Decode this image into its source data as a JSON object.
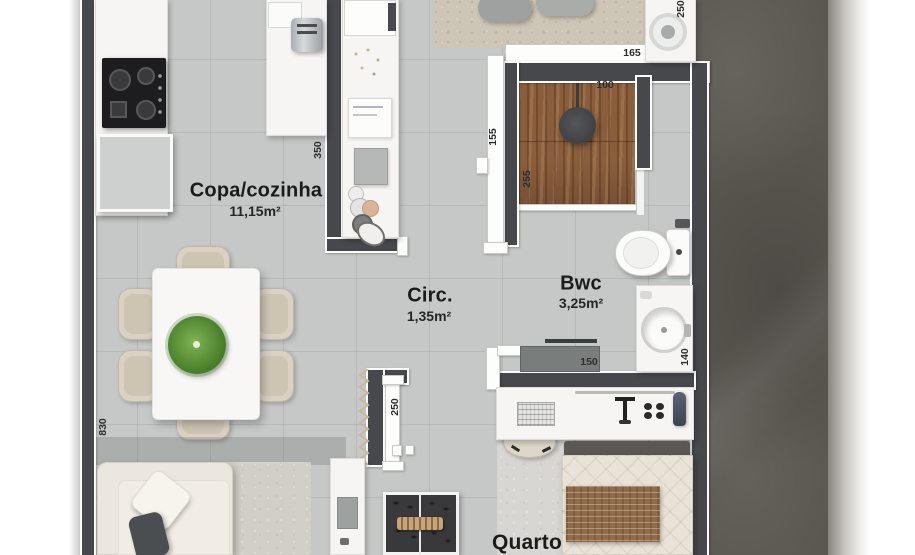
{
  "plan_title": "Apartment floor plan",
  "rooms": {
    "kitchen": {
      "name": "Copa/cozinha",
      "area": "11,15m²"
    },
    "circulation": {
      "name": "Circ.",
      "area": "1,35m²"
    },
    "bathroom": {
      "name": "Bwc",
      "area": "3,25m²"
    },
    "bedroom": {
      "name": "Quarto"
    }
  },
  "dimensions_cm": {
    "laundry_width": "250",
    "entry_width": "165",
    "shower_width": "100",
    "hall_door_width": "155",
    "shower_depth": "255",
    "kitchen_counter_length": "350",
    "living_length": "830",
    "bedroom_door_wall": "250",
    "vanity_width": "150",
    "vanity_depth": "140"
  },
  "colors": {
    "wall": "#47484b",
    "floor_tile": "#c6c8c7",
    "exterior_mass": "#5b5751",
    "shower_wood": "#8a5e3c",
    "plant_green": "#4e8f3a",
    "label_text": "#1b1b1b"
  }
}
